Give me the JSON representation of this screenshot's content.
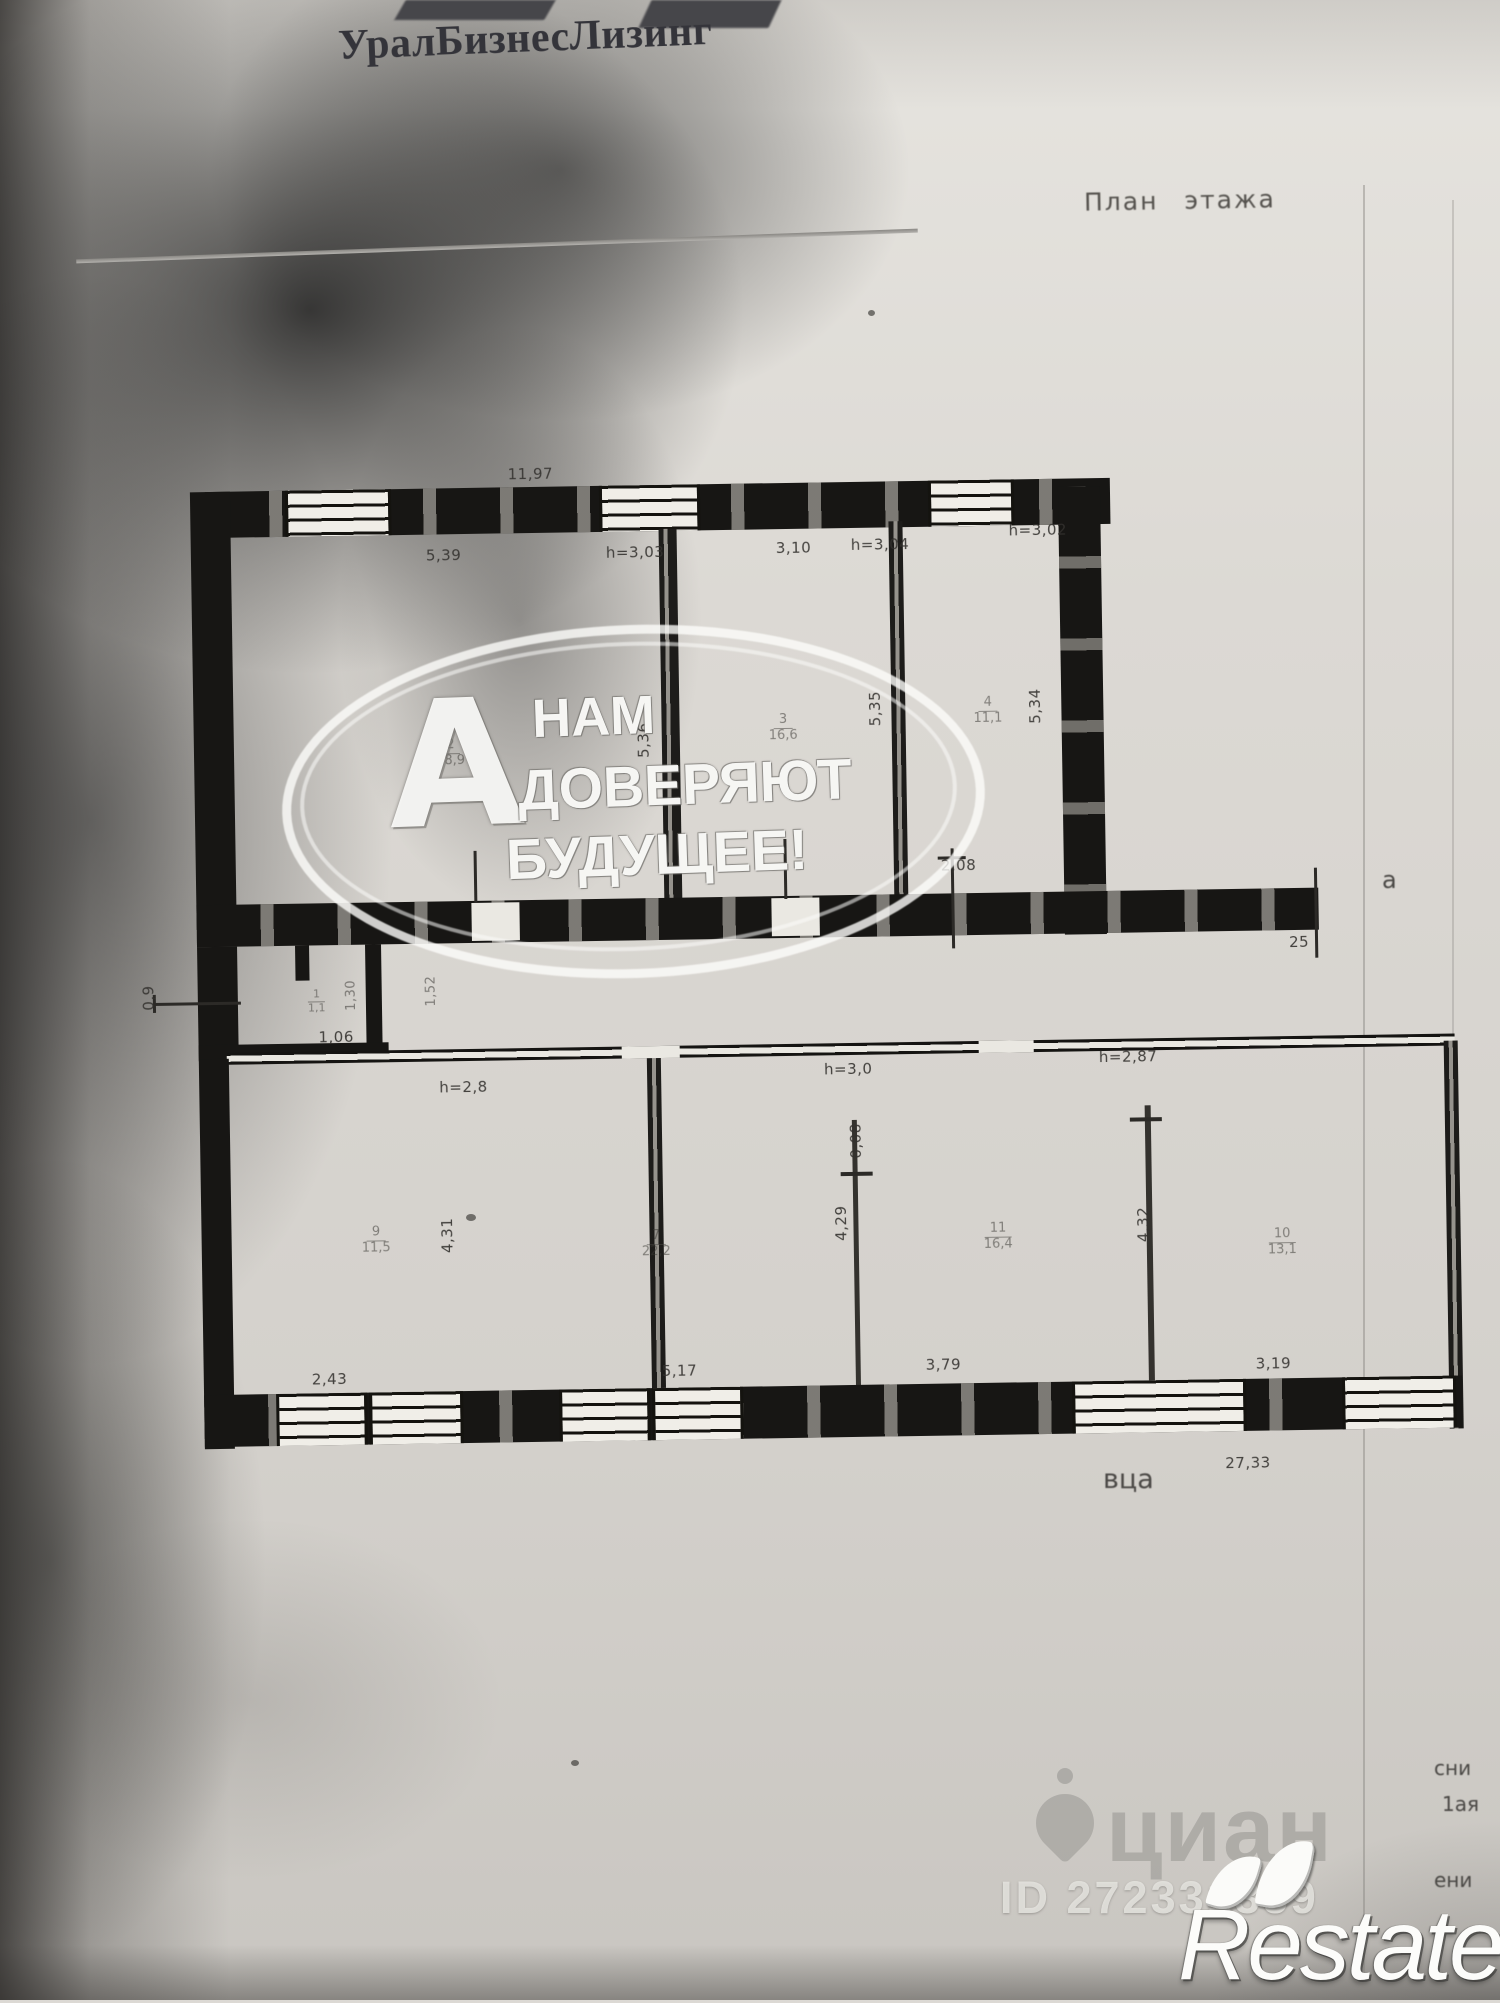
{
  "header": {
    "company": "УралБизнесЛизинг",
    "plan_label": "План этажа"
  },
  "plan": {
    "top_width": "11,97",
    "bottom_width": "27,33",
    "upper": {
      "r2": {
        "num": "2",
        "area": "28,9",
        "w": "5,39",
        "h": "h=3,03",
        "d": "5,36"
      },
      "r3": {
        "num": "3",
        "area": "16,6",
        "w": "3,10",
        "h": "h=3,04",
        "d": "5,35"
      },
      "r4": {
        "num": "4",
        "area": "11,1",
        "w": "2,08",
        "h": "h=3,02",
        "d": "5,34"
      },
      "right_ext": "25"
    },
    "entry": {
      "door_w": "0,9",
      "w": "1,06",
      "num": "1",
      "area": "1,1",
      "d1": "1,30",
      "d2": "1,52"
    },
    "lower": {
      "h1": "h=2,8",
      "h2": "h=3,0",
      "h3": "h=2,87",
      "thin": "0,08",
      "rA": {
        "num": "9",
        "area": "11,5",
        "d": "4,31",
        "w": "2,43"
      },
      "rB": {
        "num": "7",
        "area": "22,2",
        "d": "4,29",
        "w": "5,17"
      },
      "rC": {
        "num": "11",
        "area": "16,4",
        "d": "4,32",
        "w": "3,79"
      },
      "rD": {
        "num": "10",
        "area": "13,1",
        "w": "3,19"
      }
    },
    "fragments": {
      "a": "а",
      "vtsa": "вца",
      "sni": "сни",
      "aya": "1ая",
      "eni": "ени"
    }
  },
  "watermark": {
    "line1": "НАМ",
    "line2": "ДОВЕРЯЮТ",
    "line3": "БУДУЩЕЕ!",
    "logo_letter": "А"
  },
  "cian": {
    "name": "циан",
    "id": "ID 272331359"
  },
  "restate": {
    "name": "Restate"
  },
  "colors": {
    "wall": "#171614",
    "paper": "#dcd9d4",
    "watermark_grey": "#989692",
    "accent_white": "#fcfcfa"
  }
}
